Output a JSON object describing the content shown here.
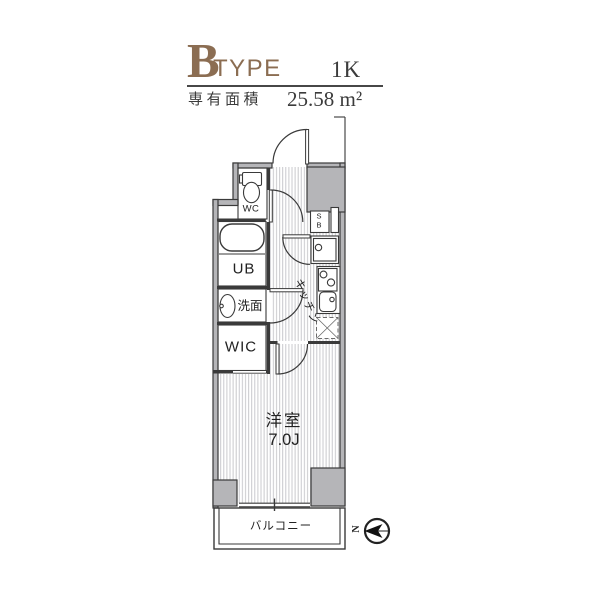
{
  "header": {
    "type_letter": "B",
    "type_word": "TYPE",
    "plan_type": "1K",
    "area_label": "専有面積",
    "area_value": "25.58 m²"
  },
  "floorplan": {
    "labels": {
      "wc": "WC",
      "bath": "UB",
      "washroom": "洗面",
      "closet": "WIC",
      "kitchen": "キッチン",
      "room": "洋室",
      "room_size": "7.0J",
      "balcony": "バルコニー",
      "shoe_box": "SB"
    },
    "compass": {
      "north": "N"
    }
  },
  "colors": {
    "accent_brown": "#8b6d52",
    "wall_gray": "#b5b5b8",
    "line_dark": "#3a3a3a",
    "floor_stripe": "#c9c9cd"
  }
}
